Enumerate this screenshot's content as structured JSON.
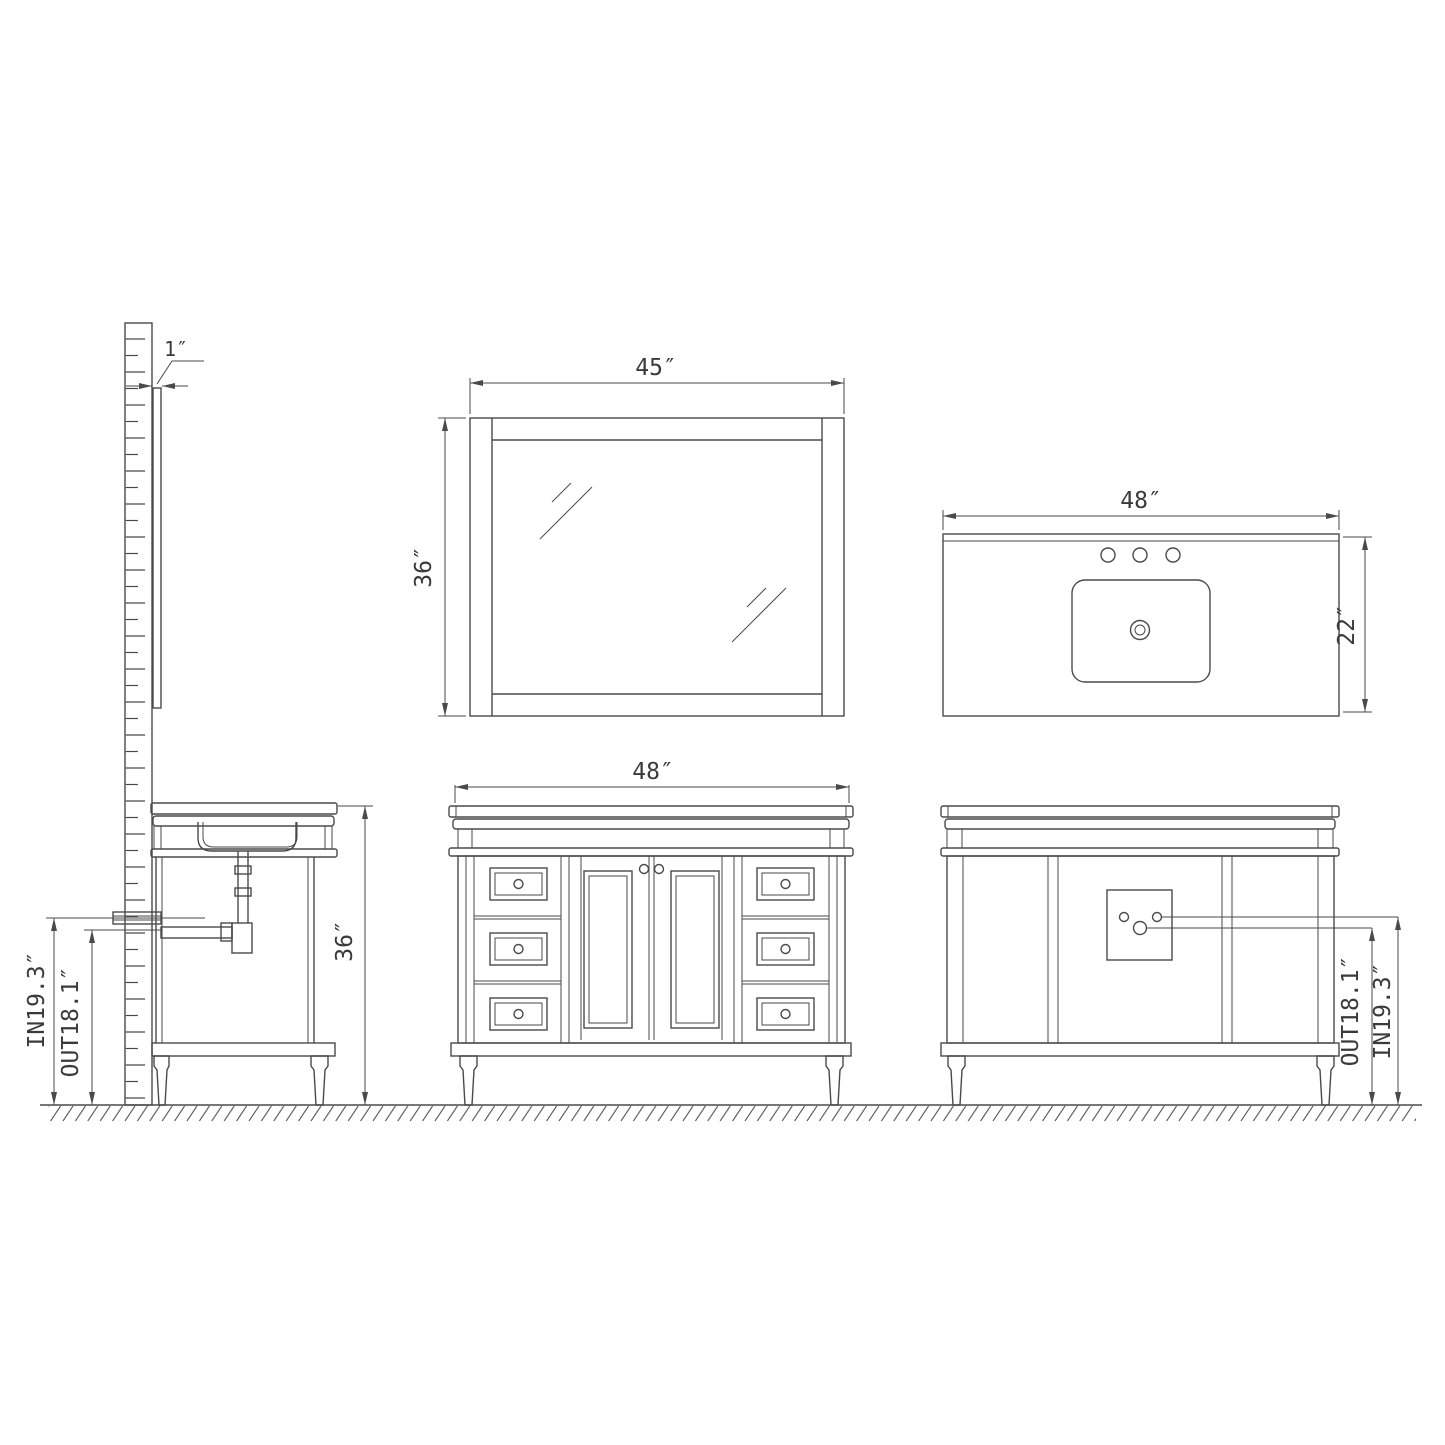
{
  "drawing": {
    "background_color": "#ffffff",
    "line_color": "#4a4a4a",
    "text_color": "#3a3a3a",
    "views": {
      "side_section": {
        "mirror_thickness_label": "1″",
        "height_label": "36″",
        "drain_in_label": "IN19.3″",
        "drain_out_label": "OUT18.1″"
      },
      "mirror_front": {
        "width_label": "45″",
        "height_label": "36″"
      },
      "countertop_top": {
        "width_label": "48″",
        "depth_label": "22″",
        "faucet_hole_count": 3
      },
      "vanity_front": {
        "width_label": "48″",
        "drawer_count": 6,
        "door_count": 2
      },
      "vanity_back": {
        "drain_out_label": "OUT18.1″",
        "drain_in_label": "IN19.3″"
      }
    }
  }
}
